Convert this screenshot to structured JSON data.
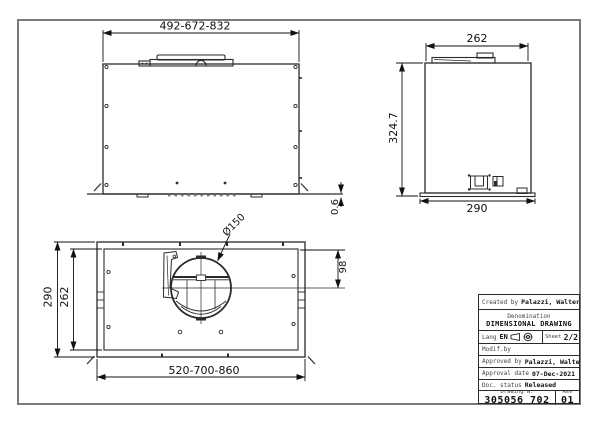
{
  "drawing": {
    "front_view": {
      "width_dim": "492-672-832",
      "panel_gap_dim": "0.6"
    },
    "side_view": {
      "top_width_dim": "262",
      "height_dim": "324.7",
      "bottom_width_dim": "290"
    },
    "plan_view": {
      "outer_depth_dim": "290",
      "inner_depth_dim": "262",
      "width_dim": "520-700-860",
      "duct_diameter_label": "Ø150",
      "duct_offset_dim": "98"
    }
  },
  "title_block": {
    "created_by_label": "Created by",
    "created_by": "Palazzi, Walter",
    "denomination_label": "Denomination",
    "denomination": "DIMENSIONAL DRAWING",
    "lang_label": "Lang",
    "lang": "EN",
    "sheet_label": "Sheet",
    "sheet": "2/2",
    "modif_by_label": "Modif.by",
    "approved_by_label": "Approved by",
    "approved_by": "Palazzi, Walter",
    "approval_date_label": "Approval date",
    "approval_date": "07-Dec-2021",
    "doc_status_label": "Doc. status",
    "doc_status": "Released",
    "drawing_n_label": "Drawing N.",
    "drawing_n": "305056 702",
    "rev_label": "Rev",
    "rev": "01"
  },
  "colors": {
    "line": "#2a2a2a",
    "frame": "#7a7a7a",
    "background": "#ffffff"
  }
}
